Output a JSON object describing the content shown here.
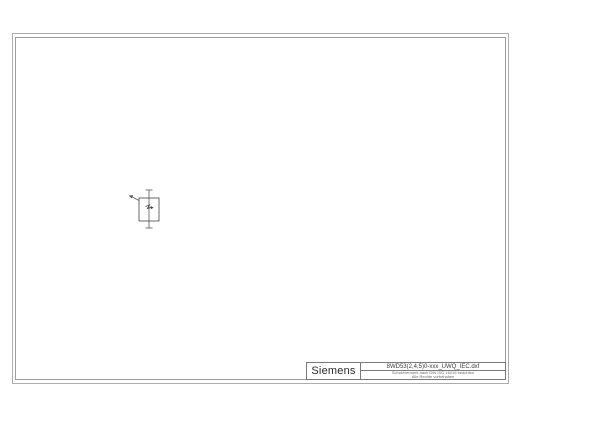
{
  "page": {
    "background_color": "#ffffff",
    "frame_color": "#a8a8a8",
    "line_color": "#4a4a4a"
  },
  "title_block": {
    "brand": "Siemens",
    "filename": "8WD53(2,4,5)0-xxx_UWQ_IEC.dxf",
    "note_line1": "Schutzvermerk nach DIN ISO 16016 beachten",
    "note_line2": "Alle Rechte vorbehalten"
  },
  "drawing": {
    "symbol_name": "signal-element-symbol",
    "icons": [
      "flash-icon",
      "actuation-arrow-icon"
    ],
    "terminal_marks": [
      "top-terminal-dash",
      "bottom-terminal-dash"
    ]
  }
}
